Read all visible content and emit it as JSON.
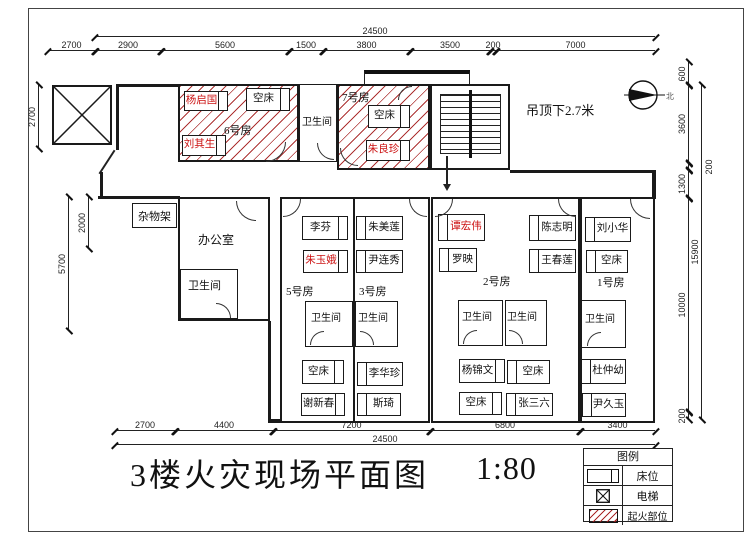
{
  "title": {
    "text": "3楼火灾现场平面图",
    "scale": "1:80"
  },
  "annotations": {
    "ceiling_note": "吊顶下2.7米",
    "north_label": "北"
  },
  "legend": {
    "title": "图例",
    "items": [
      "床位",
      "电梯",
      "起火部位"
    ]
  },
  "rooms": {
    "room6": "6号房",
    "room7": "7号房",
    "room5": "5号房",
    "room3": "3号房",
    "room2": "2号房",
    "room1": "1号房",
    "office": "办公室",
    "storage_rack": "杂物架",
    "bathroom": "卫生间"
  },
  "beds": {
    "room6": [
      {
        "name": "杨启国",
        "red": true
      },
      {
        "name": "空床",
        "red": false
      },
      {
        "name": "刘其生",
        "red": true
      }
    ],
    "room7": [
      {
        "name": "空床",
        "red": false
      },
      {
        "name": "朱良珍",
        "red": true
      }
    ],
    "room5": [
      {
        "name": "李芬",
        "red": false
      },
      {
        "name": "朱玉娥",
        "red": true
      },
      {
        "name": "空床",
        "red": false
      },
      {
        "name": "谢新春",
        "red": false
      }
    ],
    "room3": [
      {
        "name": "朱美莲",
        "red": false
      },
      {
        "name": "尹连秀",
        "red": false
      },
      {
        "name": "李华珍",
        "red": false
      },
      {
        "name": "斯琦",
        "red": false
      }
    ],
    "room2": [
      {
        "name": "谭宏伟",
        "red": true
      },
      {
        "name": "罗映",
        "red": false
      },
      {
        "name": "陈志明",
        "red": false
      },
      {
        "name": "王春莲",
        "red": false
      },
      {
        "name": "杨锦文",
        "red": false
      },
      {
        "name": "空床",
        "red": false
      },
      {
        "name": "空床",
        "red": false
      },
      {
        "name": "张三六",
        "red": false
      }
    ],
    "room1": [
      {
        "name": "刘小华",
        "red": false
      },
      {
        "name": "空床",
        "red": false
      },
      {
        "name": "杜仲幼",
        "red": false
      },
      {
        "name": "尹久玉",
        "red": false
      }
    ]
  },
  "dims": {
    "top_overall": "24500",
    "top": [
      "2700",
      "2900",
      "5600",
      "1500",
      "3800",
      "3500",
      "200",
      "7000"
    ],
    "bottom": [
      "2700",
      "4400",
      "7200",
      "6800",
      "3400"
    ],
    "bottom_overall": "24500",
    "left": [
      "2700",
      "2000",
      "5700"
    ],
    "right": [
      "600",
      "3600",
      "200",
      "1300",
      "10000",
      "200"
    ],
    "right_overall": "15900"
  },
  "colors": {
    "fire_hatch": "#a51c1c",
    "victim_name": "#cc1111"
  }
}
